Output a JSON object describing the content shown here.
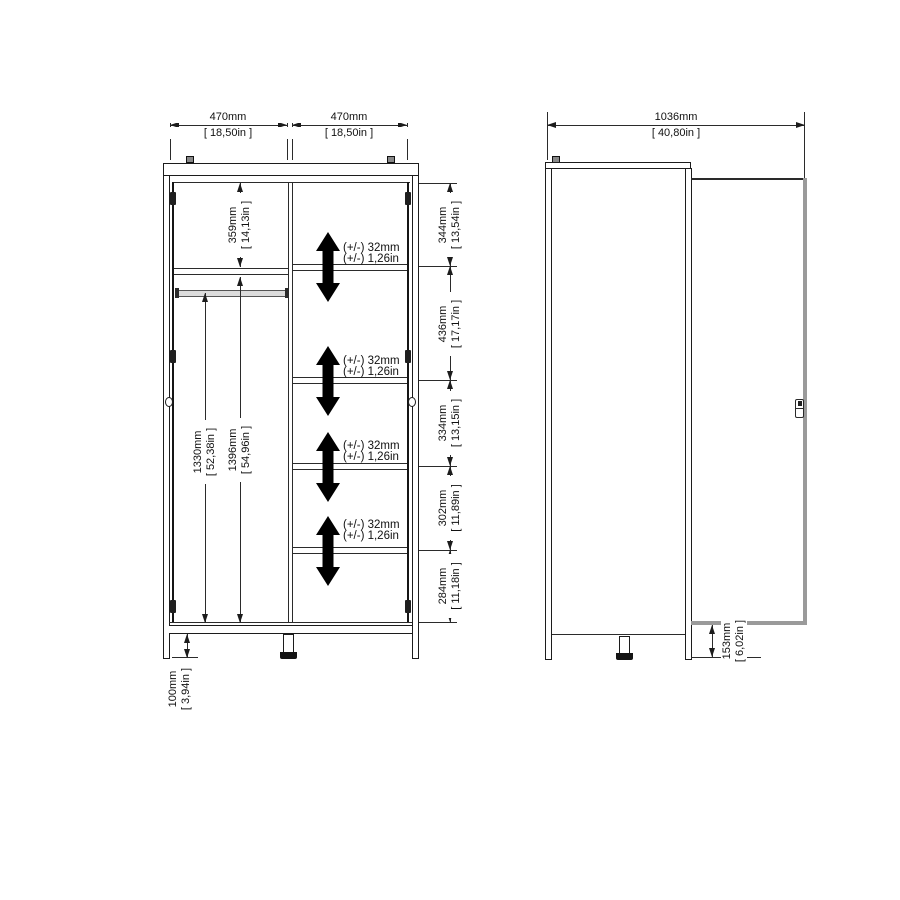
{
  "front": {
    "doors": {
      "left": {
        "mm": "470mm",
        "in": "[ 18,50in ]"
      },
      "right": {
        "mm": "470mm",
        "in": "[ 18,50in ]"
      }
    },
    "top_shelf": {
      "mm": "359mm",
      "in": "[ 14,13in ]"
    },
    "hang_space": {
      "mm": "1330mm",
      "in": "[ 52,38in ]"
    },
    "interior": {
      "mm": "1396mm",
      "in": "[ 54,96in ]"
    },
    "sections": [
      {
        "mm": "344mm",
        "in": "[ 13,54in ]"
      },
      {
        "mm": "436mm",
        "in": "[ 17,17in ]"
      },
      {
        "mm": "334mm",
        "in": "[ 13,15in ]"
      },
      {
        "mm": "302mm",
        "in": "[ 11,89in ]"
      },
      {
        "mm": "284mm",
        "in": "[ 11,18in ]"
      }
    ],
    "shelf_adjust": {
      "mm": "(+/-) 32mm",
      "in": "(+/-) 1,26in"
    },
    "legs": {
      "mm": "100mm",
      "in": "[ 3,94in ]"
    }
  },
  "side": {
    "depth_open": {
      "mm": "1036mm",
      "in": "[ 40,80in ]"
    },
    "door_clearance": {
      "mm": "153mm",
      "in": "[ 6,02in ]"
    }
  }
}
